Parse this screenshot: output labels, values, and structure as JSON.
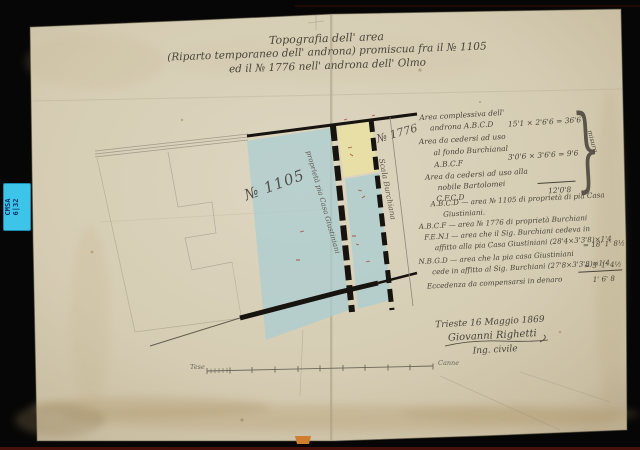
{
  "photo": {
    "background_color": "#060606",
    "sticker": {
      "line1": "CMSA",
      "line2": "6|32",
      "color": "#3cc5e8"
    }
  },
  "document": {
    "paper_color": "#d7cfb8",
    "title": {
      "line1": "Topografia dell' area",
      "line2": "(Riparto temporaneo dell' androna) promiscua fra il № 1105",
      "line3": "ed il № 1776 nell' androna dell' Olmo"
    },
    "plan": {
      "parcel_left_label": "№ 1105",
      "parcel_left_owner": "proprietà pia Casa Giustiniani",
      "strip_label": "№ 1776",
      "strip_name": "Scala Burchiana",
      "wash_blue": "#a9cdd2",
      "wash_yellow": "#e9e0a4",
      "wall_color": "#17140f"
    },
    "measurements_block": {
      "lines": [
        "Area complessiva dell'",
        "androna A.B.C.D",
        "Area da cedersi ad uso",
        "al fondo Burchianal",
        "A.B.C.F",
        "Area da cedersi ad uso alla",
        "nobile Bartolomei",
        "C.F.C.D"
      ],
      "values": [
        "15'1 × 2'6'6 = 36'6",
        "3'0'6 × 3'6'6 = 9'6",
        "12'0'8"
      ],
      "side_note": "misura",
      "brace": "}"
    },
    "legend_block": {
      "lines": [
        "A.B.C.D — area № 1105 di proprietà di pia Casa",
        "Giustiniani.",
        "A.B.C.F — area № 1776 di proprietà Burchiani",
        "F.E.N.I — area che il Sig. Burchiani cedeva in",
        "affitto alla pia Casa Giustiniani (28'4×3'3'8)×1'4",
        "N.B.G.D — area che la pia casa Giustiniani",
        "cede in affitto al Sig. Burchiani (27'8×3'3'8)×1'4",
        "Eccedenza da compensarsi in denaro"
      ],
      "values": [
        "= 18' 1' 8½",
        "= 5' 1' 4½",
        "1' 6' 8"
      ]
    },
    "signature": {
      "place_date": "Trieste 16 Maggio 1869",
      "name": "Giovanni Righetti",
      "role": "Ing. civile"
    },
    "scale_bar": {
      "left_label": "Tese",
      "right_label": "Canne"
    }
  }
}
